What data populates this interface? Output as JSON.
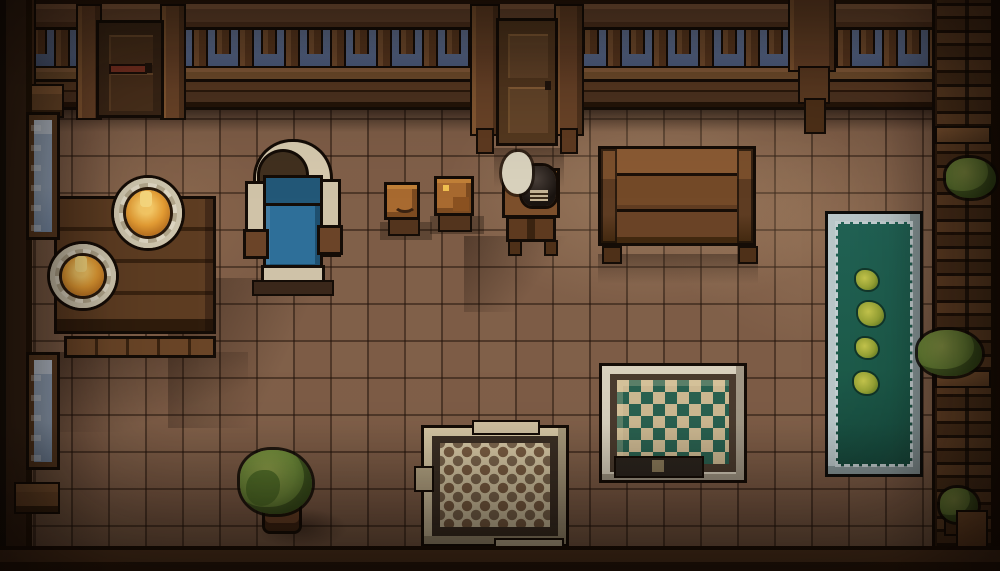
{
  "scene": {
    "title": "Top-down pixel-art tavern room at dusk"
  },
  "objects": {
    "railing": {
      "label": "Balcony railing with sky behind"
    },
    "door_left": {
      "label": "Closed wooden door"
    },
    "door_center": {
      "label": "Closed wooden door"
    },
    "window_upper": {
      "label": "Frosted window"
    },
    "window_lower": {
      "label": "Frosted window"
    },
    "dining_table": {
      "label": "Plank dining table"
    },
    "bench": {
      "label": "Wooden bench"
    },
    "plate_1": {
      "label": "Plate of hot food"
    },
    "plate_2": {
      "label": "Plate of hot food"
    },
    "bed": {
      "label": "Blue single bed"
    },
    "stool_1": {
      "label": "Small stool with bowl"
    },
    "stool_2": {
      "label": "Small crate with food"
    },
    "kettle_stand": {
      "label": "Stand with black kettle"
    },
    "smoke": {
      "label": "Steam puff"
    },
    "long_table": {
      "label": "Long wooden table"
    },
    "runner_rug": {
      "label": "Green runner rug with flower motifs"
    },
    "diamond_mat": {
      "label": "Diamond-patterned game mat"
    },
    "woven_rug": {
      "label": "Woven checkered rug"
    },
    "potted_plant": {
      "label": "Potted shrub"
    },
    "shelf_wall": {
      "label": "Shelf wall with plants"
    },
    "shelf_plant_1": {
      "label": "Shelf plant"
    },
    "shelf_plant_2": {
      "label": "Shelf plant"
    },
    "shelf_plant_3": {
      "label": "Small potted plant"
    }
  },
  "palette": {
    "outline": "#140c06",
    "floor": "#7d5c46",
    "sky": "#5e7095",
    "glass": "#9fb2ca",
    "bed-cream": "#d6c9ae",
    "bed-blue": "#2e6f99",
    "bed-blue-dark": "#235878",
    "bed-brown": "#6b4428",
    "plate-rim": "#ded6c2",
    "plate-rim-dark": "#b2a68b",
    "food": "#e59d34",
    "food-bright": "#f6c865",
    "pot-black": "#1a1410",
    "smoke": "#d9d2bd",
    "rug-green": "#1d5c4b",
    "rug-trim": "#bcc9cb",
    "flower": "#9aa636",
    "mat-cream": "#d8d0bd",
    "mat-frame": "#4a3b2e",
    "mat-field": "#cdb992",
    "mat-green": "#2a6150",
    "weave-cream": "#d6c7a4",
    "weave-frame": "#3b2f24",
    "weave-dot": "#7c5f43",
    "leaf": "#6f8c3a",
    "leaf-dark": "#46611f",
    "pot-brown": "#6b4226",
    "stool-top": "#a86a30",
    "bottom-dark": "#1c0f06"
  }
}
